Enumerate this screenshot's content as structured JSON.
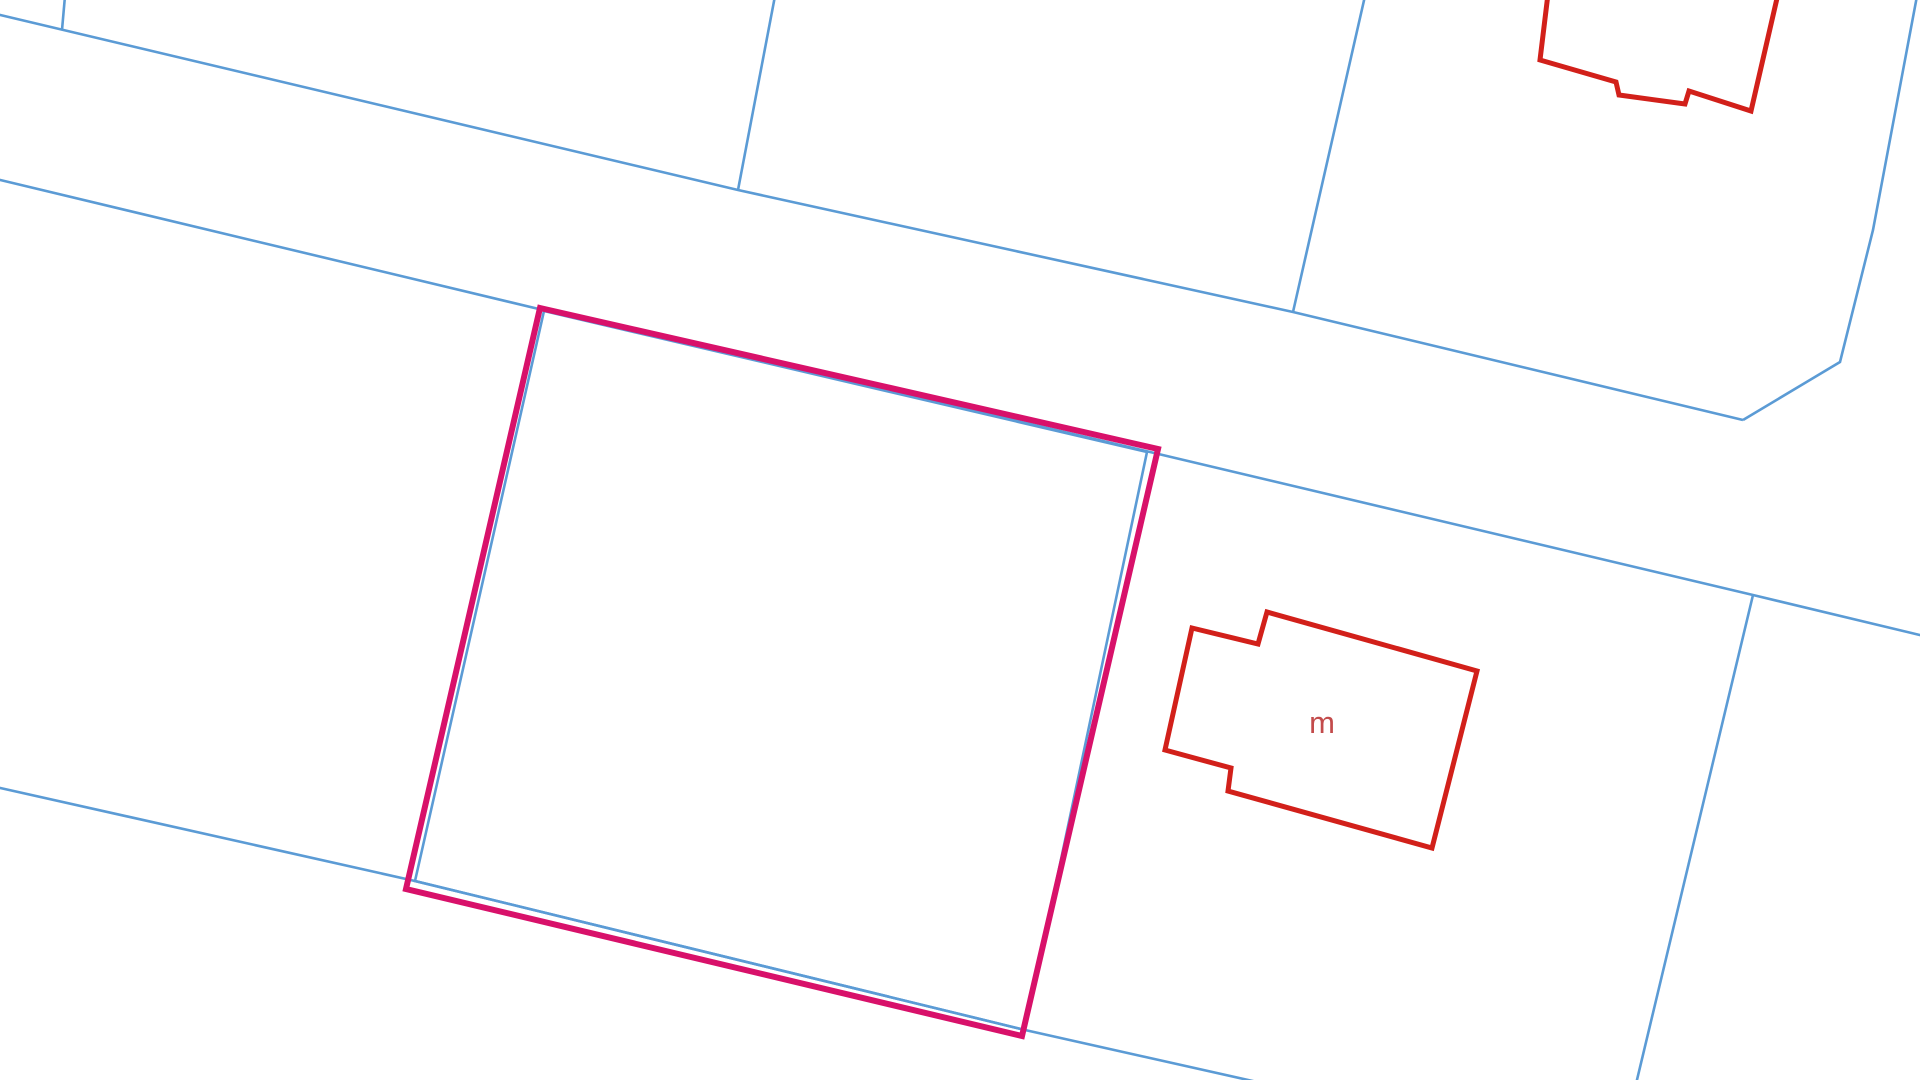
{
  "app": {
    "view": "cadastral-map",
    "background": "#ffffff"
  },
  "map": {
    "canvas": {
      "width": 1920,
      "height": 1080
    },
    "colors": {
      "parcel_line": "#5b9bd5",
      "selected_outline": "#d8116a",
      "building_outline": "#d2201a",
      "building_label": "#c34b4b"
    },
    "style": {
      "parcel_line_width": 2.6,
      "selected_line_width": 6,
      "building_line_width": 5,
      "label_font_size": 31
    },
    "parcel_lines": [
      {
        "name": "top-left-stub",
        "points": [
          [
            65,
            -4
          ],
          [
            62,
            30
          ]
        ]
      },
      {
        "name": "road-top-edge",
        "points": [
          [
            -4,
            14
          ],
          [
            738,
            190
          ],
          [
            1293,
            312
          ],
          [
            1743,
            420
          ]
        ]
      },
      {
        "name": "block-divider-1",
        "points": [
          [
            775,
            -4
          ],
          [
            738,
            190
          ]
        ]
      },
      {
        "name": "block-divider-2",
        "points": [
          [
            1365,
            -4
          ],
          [
            1293,
            312
          ]
        ]
      },
      {
        "name": "right-block-edge",
        "points": [
          [
            1917,
            -4
          ],
          [
            1873,
            230
          ],
          [
            1840,
            362
          ],
          [
            1743,
            420
          ]
        ]
      },
      {
        "name": "road-bottom-edge",
        "points": [
          [
            -4,
            179
          ],
          [
            543,
            310
          ],
          [
            1150,
            452
          ],
          [
            1753,
            595
          ],
          [
            1924,
            636
          ]
        ]
      },
      {
        "name": "right-parcel-divider",
        "points": [
          [
            1753,
            595
          ],
          [
            1636,
            1084
          ]
        ]
      },
      {
        "name": "lower-left-boundary",
        "points": [
          [
            -4,
            787
          ],
          [
            415,
            881
          ],
          [
            1025,
            1030
          ],
          [
            1266,
            1084
          ]
        ]
      }
    ],
    "selected_parcel": {
      "boundary_points": [
        [
          544,
          311
        ],
        [
          1147,
          452
        ],
        [
          1025,
          1030
        ],
        [
          415,
          881
        ]
      ],
      "highlight_points": [
        [
          540,
          308
        ],
        [
          1158,
          449
        ],
        [
          1022,
          1036
        ],
        [
          406,
          889
        ]
      ]
    },
    "buildings": [
      {
        "name": "building-north",
        "closed": false,
        "points": [
          [
            1548,
            -6
          ],
          [
            1540,
            60
          ],
          [
            1616,
            82
          ],
          [
            1619,
            95
          ],
          [
            1685,
            104
          ],
          [
            1689,
            91
          ],
          [
            1751,
            111
          ],
          [
            1778,
            -6
          ]
        ],
        "label": null
      },
      {
        "name": "building-m",
        "closed": true,
        "points": [
          [
            1192,
            628
          ],
          [
            1258,
            644
          ],
          [
            1267,
            612
          ],
          [
            1477,
            671
          ],
          [
            1432,
            848
          ],
          [
            1228,
            791
          ],
          [
            1231,
            768
          ],
          [
            1165,
            750
          ]
        ],
        "label": {
          "text": "m",
          "x": 1322,
          "y": 733
        }
      }
    ]
  }
}
